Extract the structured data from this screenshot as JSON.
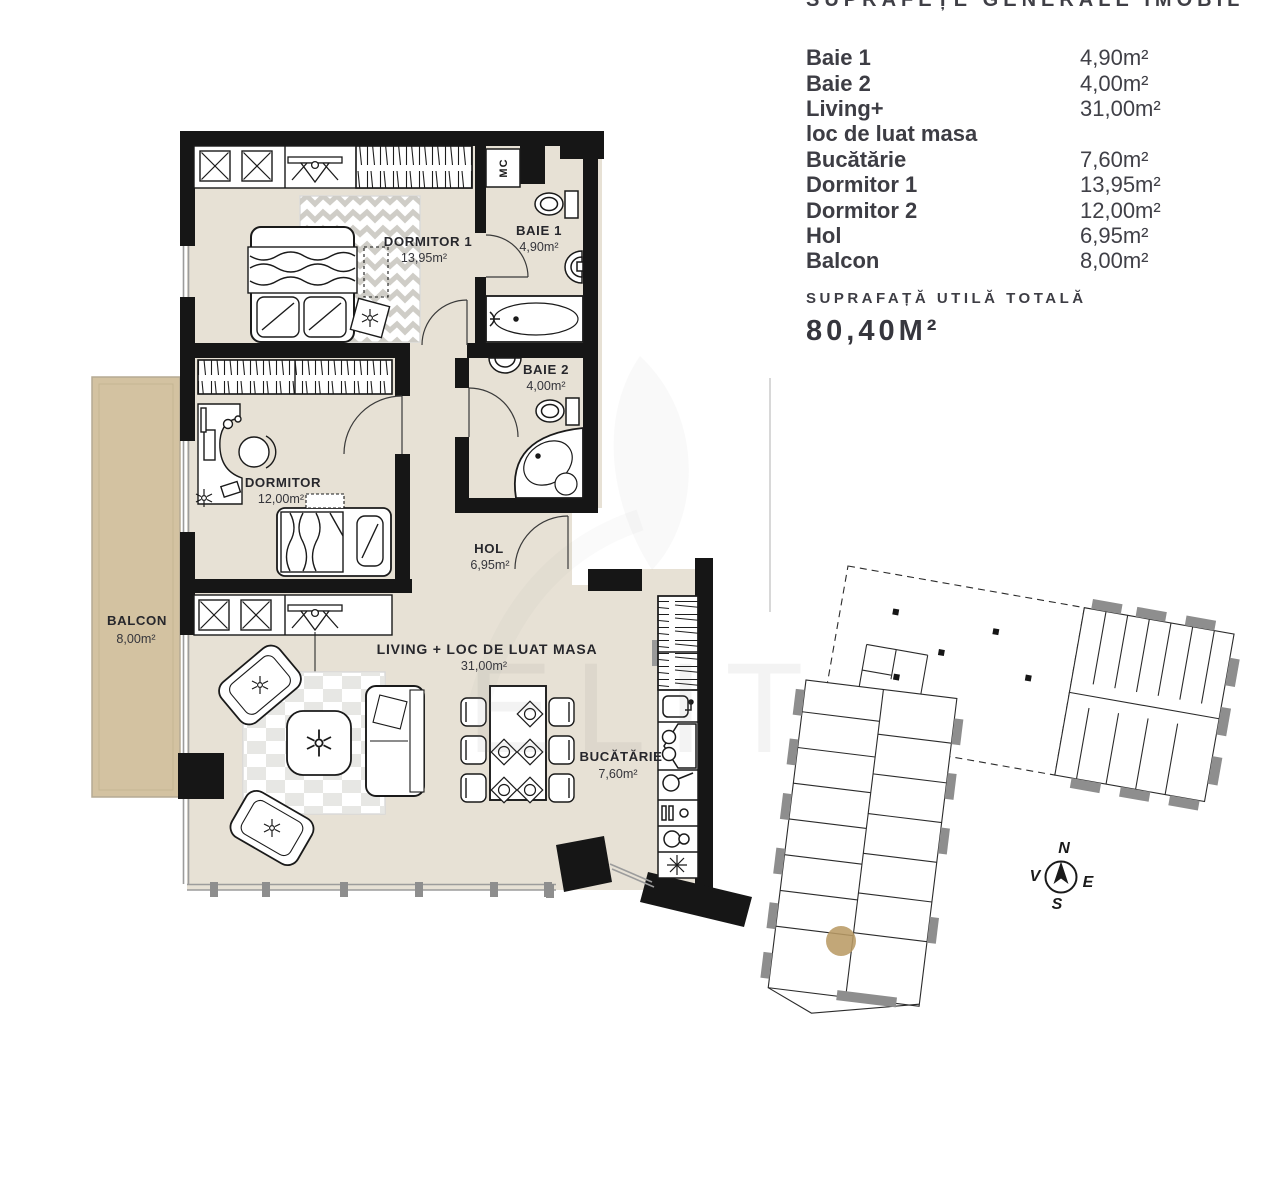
{
  "panel": {
    "title": "SUPRAFEȚE GENERALE IMOBIL",
    "rows": [
      {
        "label": "Baie 1",
        "value": "4,90m²"
      },
      {
        "label": "Baie 2",
        "value": "4,00m²"
      },
      {
        "label": "Living+",
        "value": "31,00m²"
      },
      {
        "label": "loc de luat masa",
        "value": ""
      },
      {
        "label": "Bucătărie",
        "value": "7,60m²"
      },
      {
        "label": "Dormitor 1",
        "value": "13,95m²"
      },
      {
        "label": "Dormitor 2",
        "value": "12,00m²"
      },
      {
        "label": "Hol",
        "value": "6,95m²"
      },
      {
        "label": "Balcon",
        "value": "8,00m²"
      }
    ],
    "total_label": "SUPRAFAȚĂ UTILĂ TOTALĂ",
    "total_value": "80,40M²"
  },
  "floorplan": {
    "rooms": [
      {
        "name": "DORMITOR 1",
        "area": "13,95m²"
      },
      {
        "name": "BAIE 1",
        "area": "4,90m²"
      },
      {
        "name": "BAIE 2",
        "area": "4,00m²"
      },
      {
        "name": "DORMITOR",
        "area": "12,00m²"
      },
      {
        "name": "HOL",
        "area": "6,95m²"
      },
      {
        "name": "BALCON",
        "area": "8,00m²"
      },
      {
        "name": "LIVING + LOC DE LUAT MASA",
        "area": "31,00m²"
      },
      {
        "name": "BUCĂTĂRIE",
        "area": "7,60m²"
      }
    ],
    "closet_label": "MC"
  },
  "site_plan": {
    "compass": {
      "n": "N",
      "e": "E",
      "s": "S",
      "v": "V"
    }
  },
  "watermark": "ELITE",
  "colors": {
    "wall": "#161616",
    "floor": "#e7e1d5",
    "balcony": "#d3c2a1",
    "unit_highlight": "#ba9b65",
    "text_dark": "#3d3d44"
  }
}
